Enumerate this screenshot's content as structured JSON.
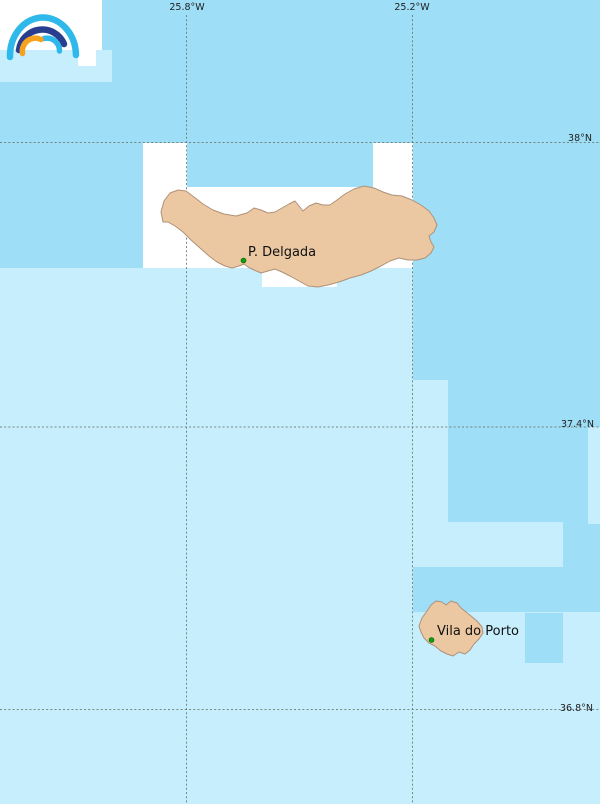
{
  "map": {
    "graticule_labels": {
      "meridians": [
        {
          "label": "25.8°W"
        },
        {
          "label": "25.2°W"
        }
      ],
      "parallels": [
        {
          "label": "38°N"
        },
        {
          "label": "37.4°N"
        },
        {
          "label": "36.8°N"
        }
      ]
    },
    "places": [
      {
        "label": "P. Delgada"
      },
      {
        "label": "Vila do Porto"
      }
    ],
    "colors": {
      "ocean": "#9EDEF7",
      "ocean_light": "#C6EEFD",
      "no_data": "#FFFFFF",
      "land": "#ECC8A2",
      "land_outline": "#AE9179",
      "graticule": "#68766A",
      "label_text": "#1F1F1F",
      "place_dot": "#12A012",
      "logo_cyan": "#2FB9EA",
      "logo_navy": "#2A3E8F",
      "logo_orange": "#F6A21E"
    }
  },
  "logo": {
    "icon": "rainbow-arcs-logo"
  }
}
